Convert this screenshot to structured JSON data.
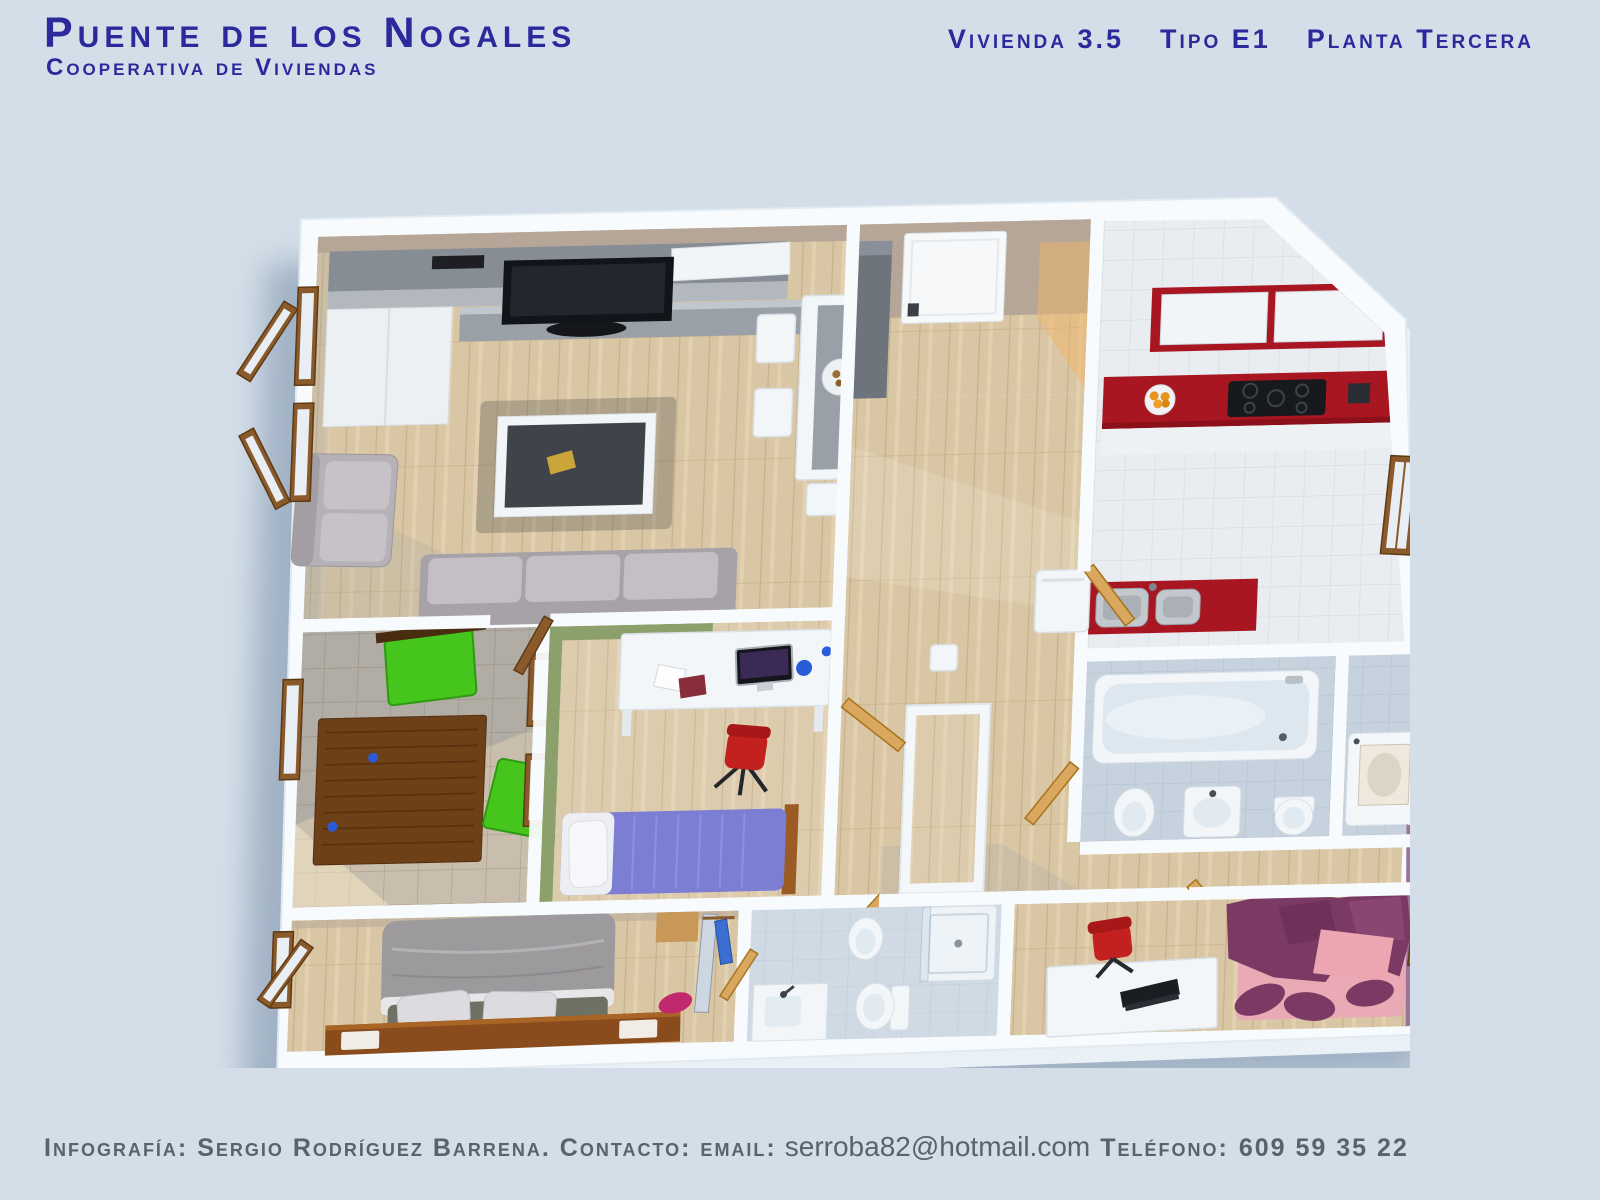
{
  "header": {
    "title": "Puente de los Nogales",
    "subtitle": "Cooperativa de Viviendas",
    "unit": "Vivienda 3.5",
    "type": "Tipo E1",
    "floor": "Planta Tercera"
  },
  "footer": {
    "credit": "Infografía: Sergio Rodríguez Barrena. Contacto: email:",
    "email": "serroba82@hotmail.com",
    "phone_label": "Teléfono:",
    "phone": "609 59 35 22"
  },
  "palette": {
    "background": "#d3dee8",
    "title_blue": "#2a2a9c",
    "footer_gray": "#5a626c",
    "wall_white": "#f8fbfd",
    "wood": "#d9c6a4",
    "tan_wall": "#b5a697",
    "kitchen_red": "#a81622",
    "tile_bath": "#c6d2de",
    "tile_terrace": "#c9bead",
    "green_wall": "#8ba06b",
    "chair_green": "#46c61c",
    "bed_blue": "#7b7ed2",
    "purple_wall": "#9b7598",
    "bed_plum": "#7b3a64",
    "oak": "#d9a85e",
    "sofa_gray": "#b5b1b6",
    "chair_red": "#c32020"
  }
}
